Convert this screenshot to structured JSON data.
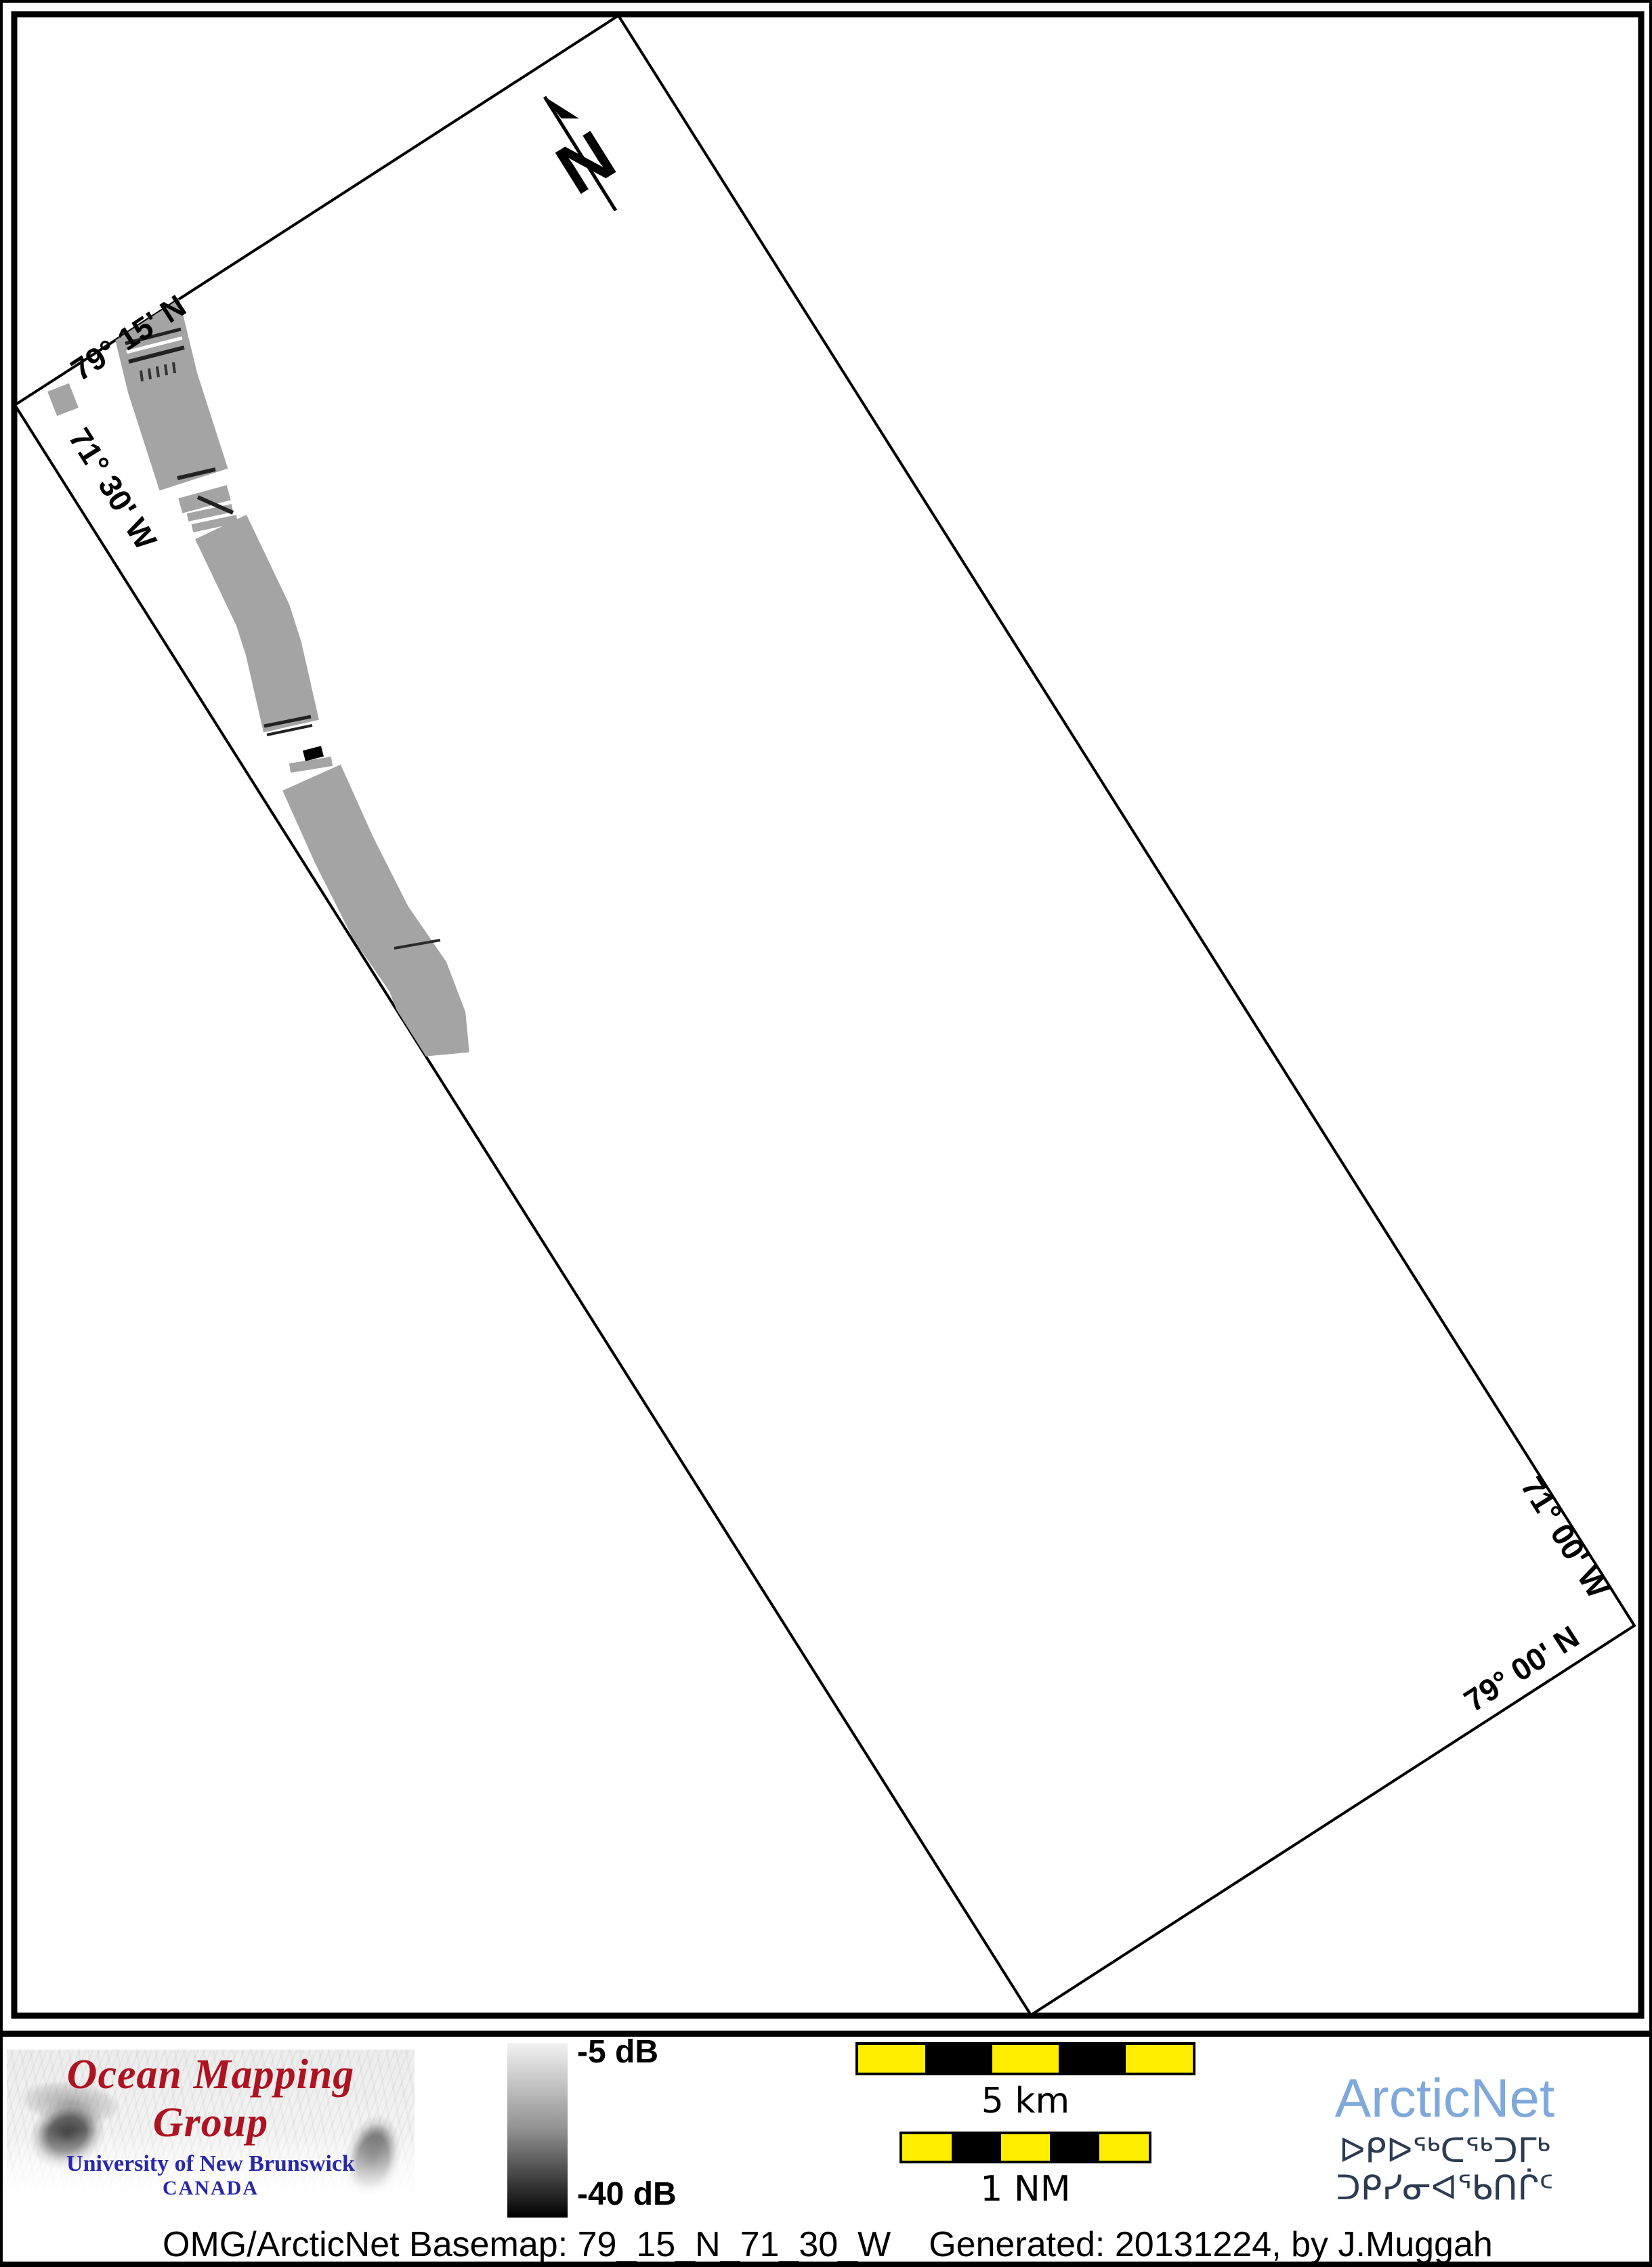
{
  "map": {
    "corner_labels": {
      "top_left_lat": "79° 15' N",
      "left_lon": "71° 30' W",
      "right_lon": "71° 00' W",
      "bottom_right_lat": "79° 00' N"
    },
    "north_label": "N",
    "frame_color": "#000000",
    "boundary_color": "#000000",
    "swath_gray": "#9a9a9a"
  },
  "colorbar": {
    "top_label": "-5 dB",
    "bottom_label": "-40 dB",
    "top_color": "#f2f2f2",
    "bottom_color": "#000000"
  },
  "scalebars": {
    "km": {
      "label": "5 km",
      "segments": [
        "#ffee00",
        "#000000",
        "#ffee00",
        "#000000",
        "#ffee00"
      ]
    },
    "nm": {
      "label": "1 NM",
      "segments": [
        "#ffee00",
        "#000000",
        "#ffee00",
        "#000000",
        "#ffee00"
      ]
    },
    "yellow": "#ffee00",
    "border_color": "#000000"
  },
  "omg_logo": {
    "title": "Ocean Mapping Group",
    "subtitle": "University of New Brunswick",
    "country": "CANADA",
    "title_color": "#ad1320",
    "text_color": "#2828a8"
  },
  "arcticnet_logo": {
    "name": "ArcticNet",
    "inuktitut": "ᐅᑭᐅᖅᑕᖅᑐᒥᒃ ᑐᑭᓯᓂᐊᖃᑎᒌᑦ",
    "name_color": "#7fa9da",
    "inuktitut_color": "#2c3c52"
  },
  "caption": {
    "basemap": "OMG/ArcticNet Basemap: 79_15_N_71_30_W",
    "generated": "Generated: 20131224, by J.Muggah"
  }
}
